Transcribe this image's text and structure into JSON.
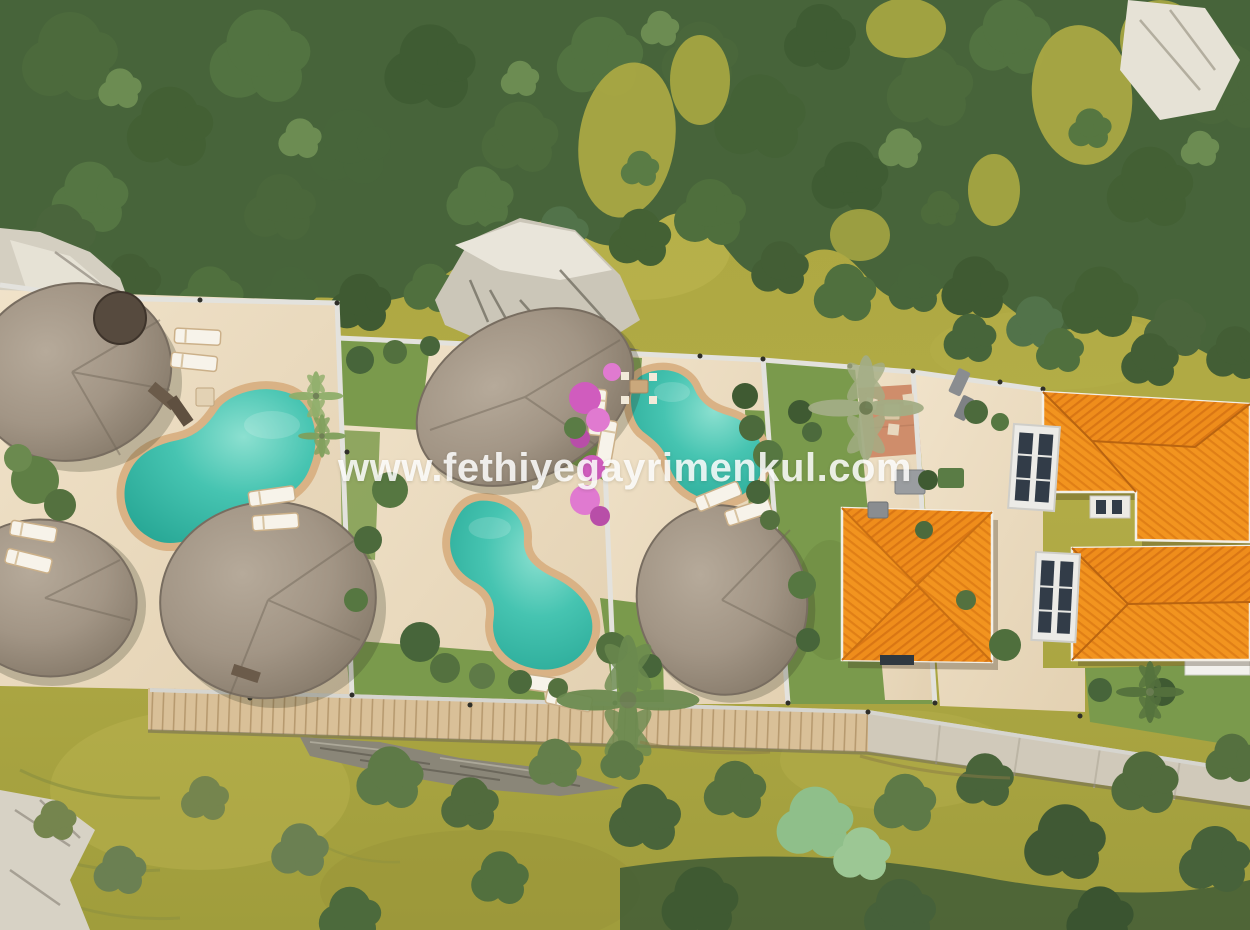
{
  "image": {
    "kind": "aerial-3d-architectural-render",
    "subject": "top-down rendering of a terraced villa development with pools among forest and meadow"
  },
  "watermark": {
    "text": "www.fethiyegayrimenkul.com"
  },
  "palette": {
    "grass": "#a9a342",
    "grass_light": "#bcb551",
    "forest": "#47643a",
    "paving": "#ecdcc2",
    "lawn": "#7a9a4c",
    "pool_water": "#3cbcaa",
    "pool_coping": "#d9b285",
    "thatch": "#a59884",
    "roof_orange": "#f2941f",
    "wall": "#e3e2dd",
    "wood_path": "#d9c098",
    "stone_path": "#d0c9ba",
    "rock_light": "#ddd8cb",
    "rock_dark": "#8a8678",
    "bougainvillea": "#d05cbe",
    "terracotta": "#cf8d6b"
  },
  "scene": {
    "terrain": "olive-green meadow with dense dark-green forest along the top, white rock outcrops, scattered shrubs below",
    "lots": [
      {
        "name": "lot-1",
        "buildings": "three round thatched-roof bungalows",
        "pool": "kidney-shaped turquoise pool",
        "furniture": "white sun loungers"
      },
      {
        "name": "lot-2",
        "buildings": "one round thatched-roof villa",
        "pool": "gourd-shaped turquoise pool",
        "furniture": "white sun loungers"
      },
      {
        "name": "lot-3",
        "buildings": "one round thatched-roof bungalow",
        "pool": "kidney-shaped turquoise pool",
        "furniture": "sun loungers and dining set",
        "landscape": "palm tree and pink bougainvillea"
      },
      {
        "name": "lot-4",
        "buildings": "square villa with orange tiled hip roof",
        "landscape": "lawn, palm tree, terracotta patio, storage boxes"
      },
      {
        "name": "lot-5",
        "buildings": "large villa with orange tiled roofs, white walls and glazed bays",
        "landscape": "stone courtyard and lawn strip"
      }
    ],
    "paths": "wooden boardwalk and stone walkway along the lower retaining wall"
  }
}
